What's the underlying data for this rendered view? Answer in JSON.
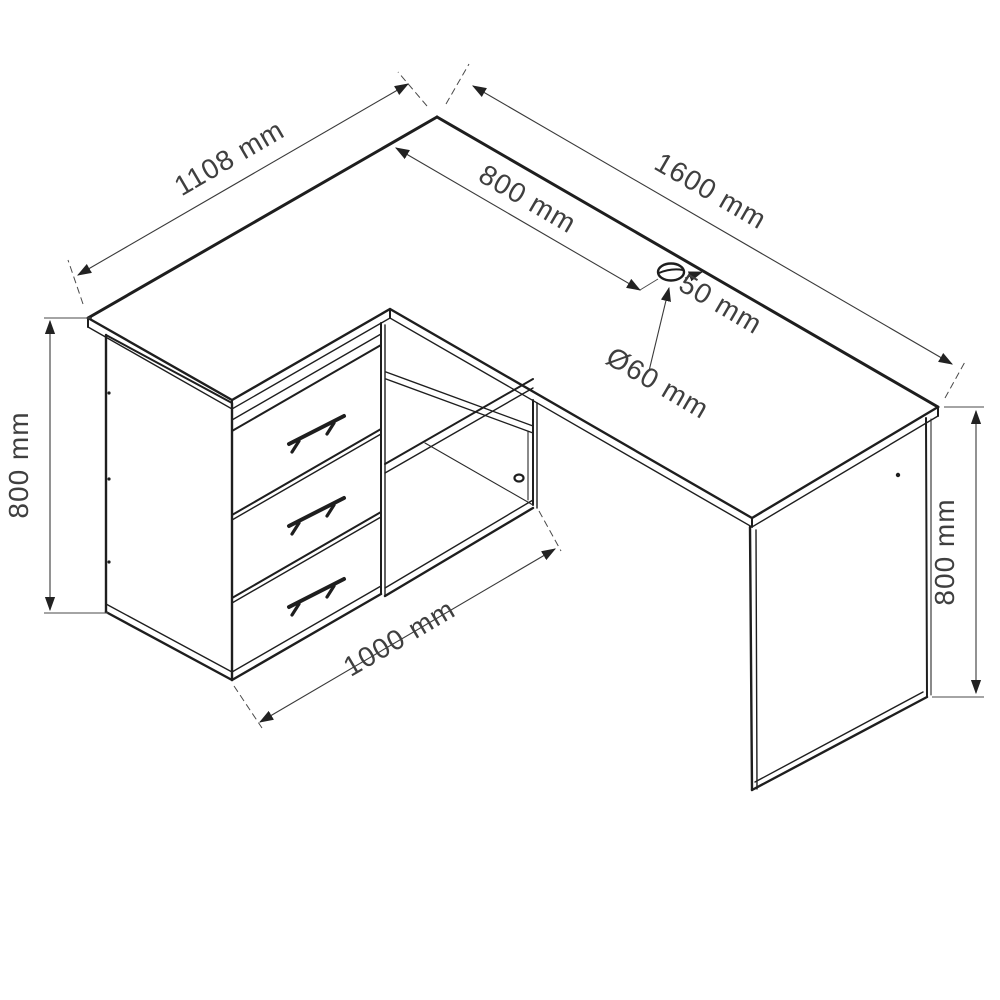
{
  "drawing": {
    "type": "furniture-technical-drawing",
    "subject": "L-shaped corner desk with three drawers, open shelf compartment, side panels and desktop cable grommet",
    "background_color": "#ffffff",
    "line_color": "#1e1e1e",
    "label_color": "#3f3f3f"
  },
  "dimensions": {
    "return_length": {
      "label": "1108 mm"
    },
    "desk_length": {
      "label": "1600 mm"
    },
    "grommet_from_left": {
      "label": "800 mm"
    },
    "grommet_from_back": {
      "label": "50 mm"
    },
    "grommet_diameter": {
      "label": "Ø60 mm"
    },
    "cabinet_height": {
      "label": "800 mm"
    },
    "desk_height": {
      "label": "800 mm"
    },
    "cabinet_width": {
      "label": "1000 mm"
    }
  }
}
